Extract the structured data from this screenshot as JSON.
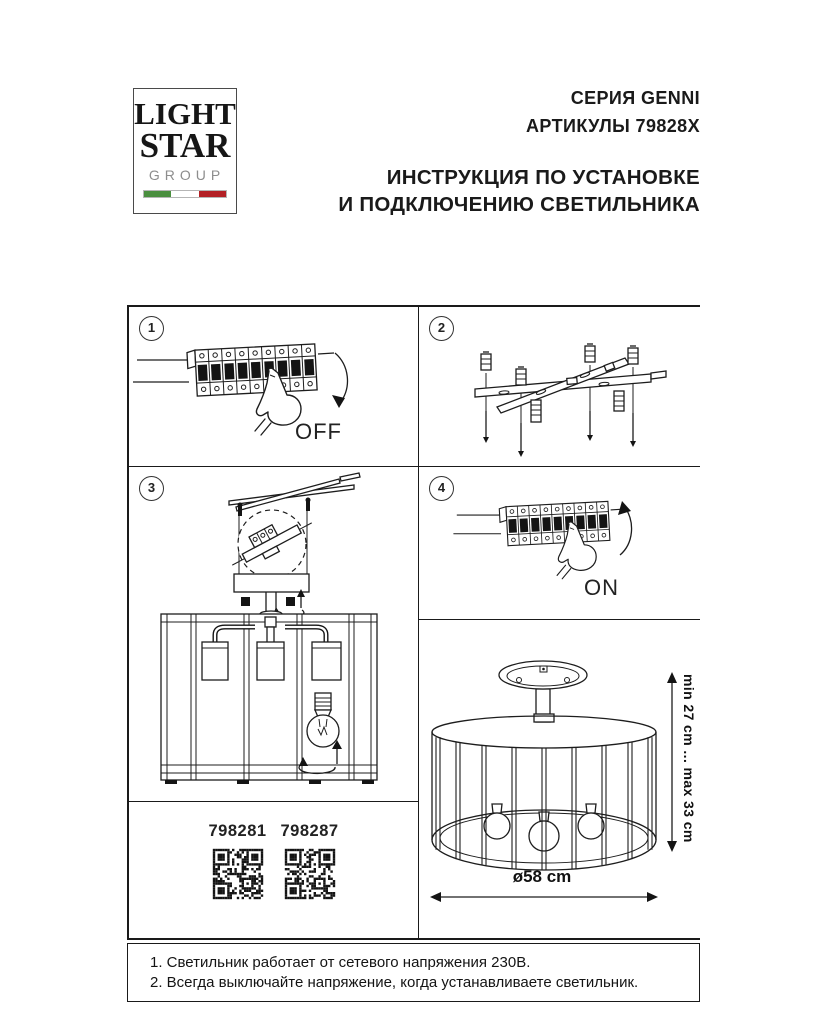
{
  "logo": {
    "line1": "LIGHT",
    "line2": "STAR",
    "line3": "GROUP"
  },
  "header": {
    "series": "СЕРИЯ GENNI",
    "articles": "АРТИКУЛЫ 79828X",
    "instruction_line1": "ИНСТРУКЦИЯ ПО УСТАНОВКЕ",
    "instruction_line2": "И ПОДКЛЮЧЕНИЮ СВЕТИЛЬНИКА"
  },
  "steps": [
    {
      "number": "1",
      "label": "OFF"
    },
    {
      "number": "2",
      "label": ""
    },
    {
      "number": "3",
      "label": ""
    },
    {
      "number": "4",
      "label": "ON"
    }
  ],
  "qr_codes": [
    "798281",
    "798287"
  ],
  "dimensions": {
    "height_range": "min 27 cm ... max 33 cm",
    "diameter": "ø58 cm"
  },
  "notes": [
    "1. Светильник работает от сетевого напряжения 230В.",
    "2. Всегда выключайте напряжение, когда устанавливаете светильник."
  ],
  "colors": {
    "ink": "#1a1a1a",
    "flag_green": "#4a8f3f",
    "flag_red": "#b32025",
    "logo_gray": "#8d8d8d"
  }
}
